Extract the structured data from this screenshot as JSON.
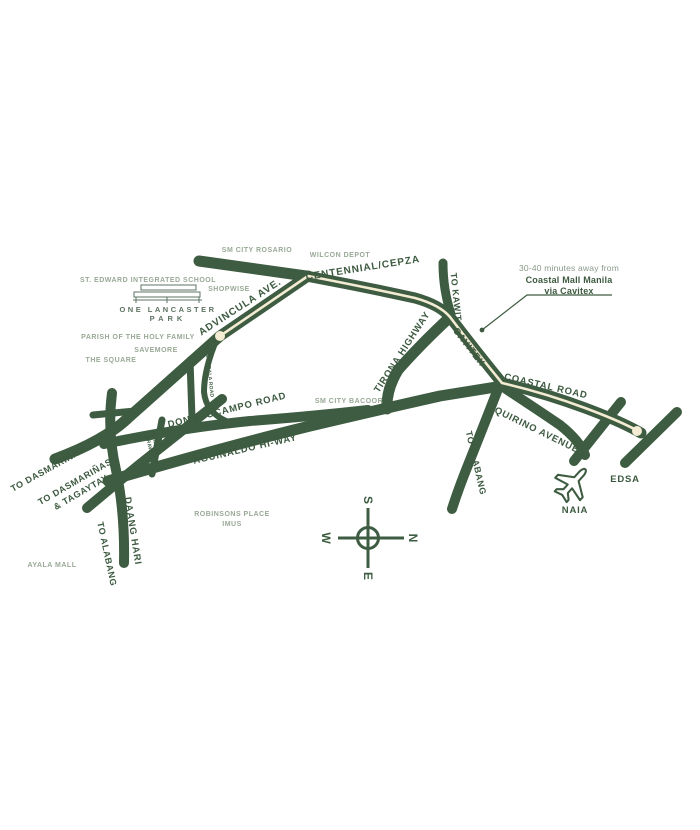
{
  "map": {
    "description": "Vicinity map of One Lancaster Park, Cavite",
    "colors": {
      "background": "#ffffff",
      "road_green": "#3e5c41",
      "dark_label": "#3d5a40",
      "light_label": "#99a996",
      "route_highlight_cream": "#f3ecd3",
      "logo_green": "#5d7363"
    },
    "roads": {
      "centennial": "CENTENNIAL/CEPZA",
      "advincula": "ADVINCULA AVE.",
      "tirona": "TIRONA HIGHWAY",
      "to_kawit": "TO KAWIT",
      "cavitex": "CAVITEX",
      "coastal": "COASTAL ROAD",
      "quirino": "QUIRINO AVENUE",
      "don_ocampo": "DON P. OCAMPO ROAD",
      "aguinaldo": "AGUINALDO HI-WAY",
      "daang_hari": "DAANG HARI",
      "to_alabang_left": "TO ALABANG",
      "to_alabang_right": "TO ALABANG",
      "to_dasmarinas": "TO DASMARIÑAS",
      "to_dasmarinas_tagaytay_line1": "TO DASMARIÑAS",
      "to_dasmarinas_tagaytay_line2": "& TAGAYTAY",
      "bucandala": "BUCANDALA ROAD",
      "patindig_line1": "PATINDIG",
      "patindig_line2": "ARAW",
      "edsa": "EDSA",
      "naia": "NAIA"
    },
    "landmarks": {
      "sm_city_rosario": "SM CITY ROSARIO",
      "wilcon_depot": "WILCON DEPOT",
      "st_edward": "ST. EDWARD INTEGRATED SCHOOL",
      "shopwise": "SHOPWISE",
      "parish": "PARISH OF THE HOLY FAMILY",
      "savemore": "SAVEMORE",
      "the_square": "THE SQUARE",
      "sm_city_bacoor": "SM CITY BACOOR",
      "robinsons_line1": "ROBINSONS PLACE",
      "robinsons_line2": "IMUS",
      "ayala_mall": "AYALA MALL"
    },
    "logo": {
      "line1": "ONE LANCASTER",
      "line2": "PARK"
    },
    "callout": {
      "line1": "30-40 minutes away from",
      "line2": "Coastal Mall Manila",
      "line3": "via Cavitex"
    },
    "compass": {
      "north": "N",
      "south": "S",
      "east": "E",
      "west": "W"
    }
  }
}
